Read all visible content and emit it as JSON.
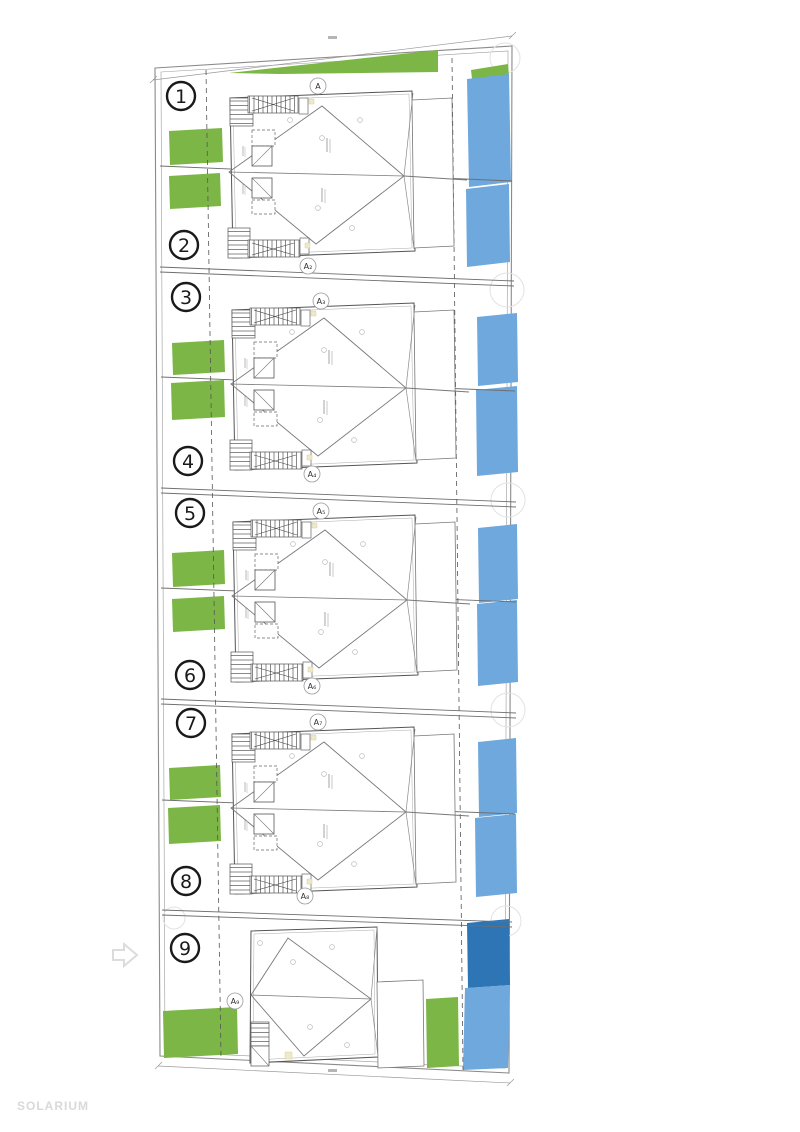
{
  "watermark": {
    "text": "SOLARIUM"
  },
  "units": {
    "u1": "1",
    "u2": "2",
    "u3": "3",
    "u4": "4",
    "u5": "5",
    "u6": "6",
    "u7": "7",
    "u8": "8",
    "u9": "9"
  },
  "markers": {
    "m1": "A",
    "m2": "A₂",
    "m3": "A₃",
    "m4": "A₄",
    "m5": "A₅",
    "m6": "A₆",
    "m7": "A₇",
    "m8": "A₈",
    "m9": "A₉"
  },
  "colors": {
    "garden": "#7cb646",
    "pool": "#6fa8dc",
    "pool_dark": "#2e75b6",
    "line": "#6e6e6e",
    "watermark": "#d9d9d9",
    "arrow": "#dcdcdc"
  },
  "plan": {
    "type": "architectural-site-plan-roof-level",
    "blocks": [
      {
        "units": [
          "1",
          "2"
        ],
        "section_top": "A",
        "section_bottom": "A₂"
      },
      {
        "units": [
          "3",
          "4"
        ],
        "section_top": "A₃",
        "section_bottom": "A₄"
      },
      {
        "units": [
          "5",
          "6"
        ],
        "section_top": "A₅",
        "section_bottom": "A₆"
      },
      {
        "units": [
          "7",
          "8"
        ],
        "section_top": "A₇",
        "section_bottom": "A₈"
      },
      {
        "units": [
          "9"
        ],
        "section": "A₉"
      }
    ],
    "legend": {
      "green_areas": "private gardens",
      "blue_areas": "pools"
    }
  }
}
